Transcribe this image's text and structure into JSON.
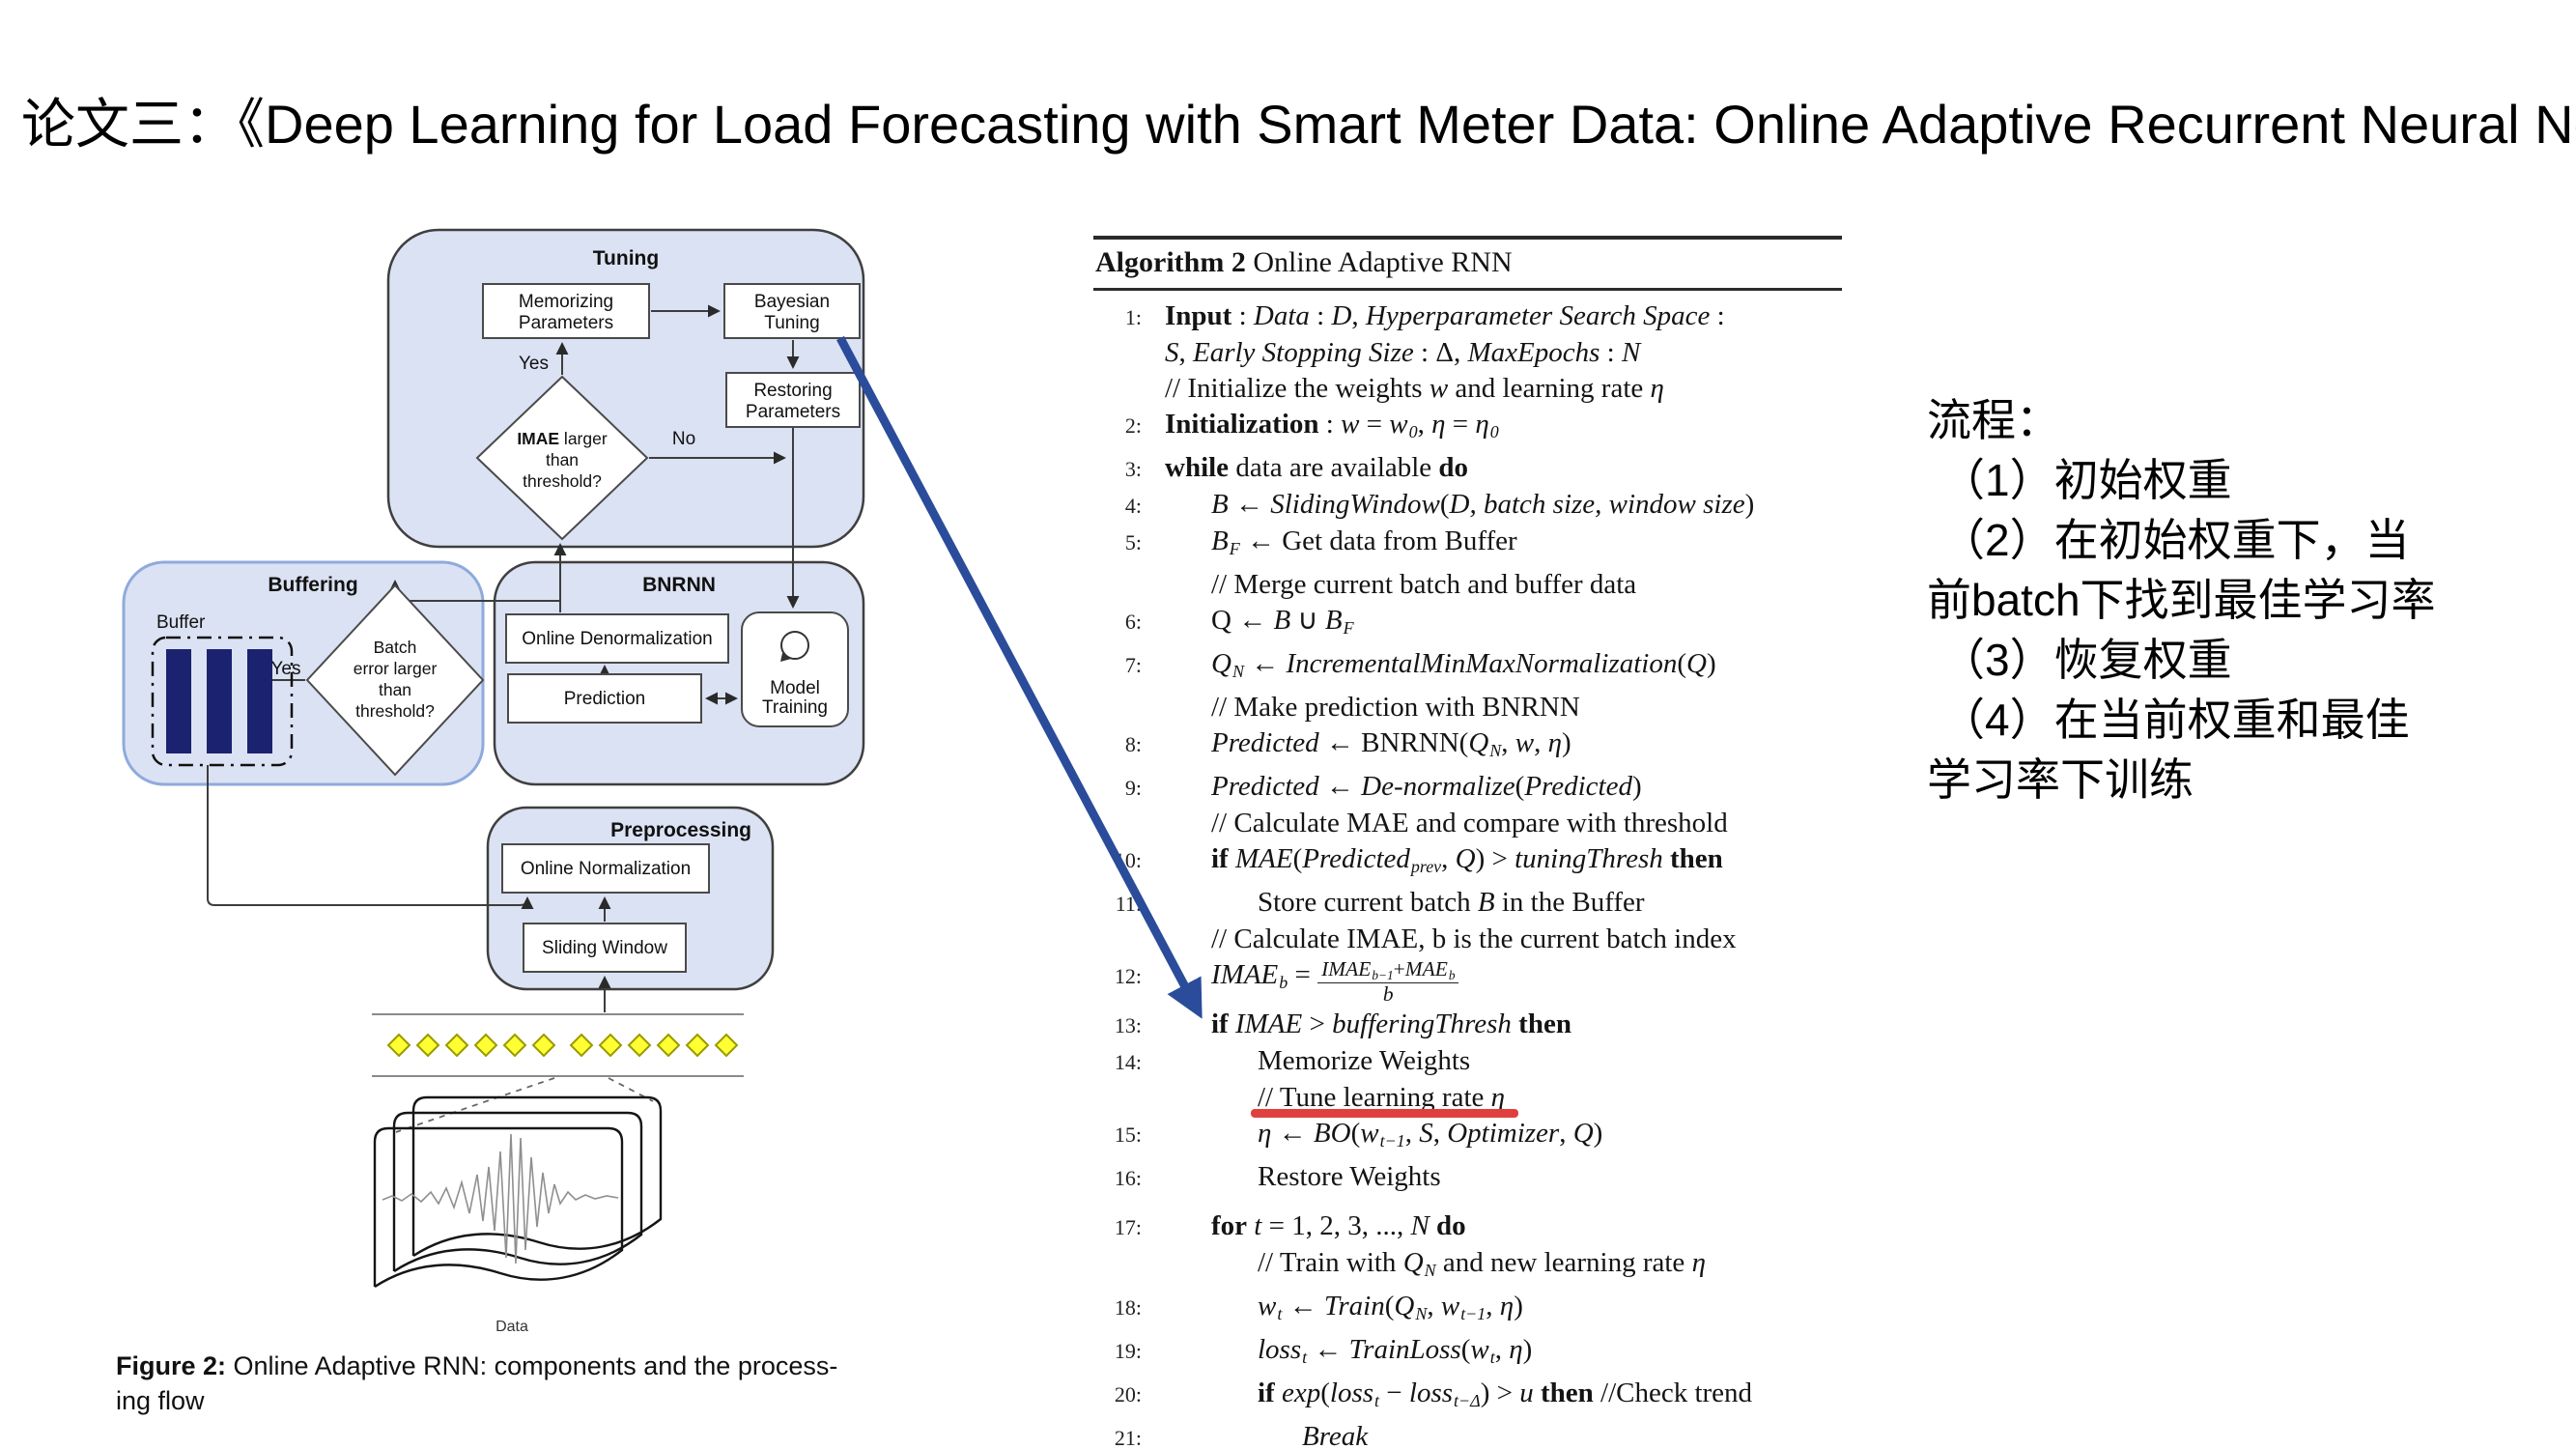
{
  "title": "论文三：《Deep Learning for Load Forecasting with Smart Meter Data: Online Adaptive Recurrent Neural Network》",
  "colors": {
    "accent_blue": "#2b4c9b",
    "underline_red": "#e0403d",
    "container_fill": "#dbe2f3",
    "container_border": "#3f3f3f",
    "buffering_border": "#8faadc",
    "bar_navy": "#1b2370",
    "stream_yellow": "#ffff33",
    "stream_border": "#9a9a00"
  },
  "flowchart": {
    "sections": {
      "tuning": "Tuning",
      "buffering": "Buffering",
      "bnrnn": "BNRNN",
      "preprocessing": "Preprocessing"
    },
    "boxes": {
      "memorizing": [
        "Memorizing",
        "Parameters"
      ],
      "bayesian": [
        "Bayesian",
        "Tuning"
      ],
      "restoring": [
        "Restoring",
        "Parameters"
      ],
      "online_denorm": "Online Denormalization",
      "prediction": "Prediction",
      "model_training": [
        "Model",
        "Training"
      ],
      "online_norm": "Online Normalization",
      "sliding_window": "Sliding Window"
    },
    "diamonds": {
      "imae": {
        "l1b": "IMAE",
        "l1r": " larger",
        "l2": "than",
        "l3": "threshold?"
      },
      "batch": [
        "Batch",
        "error larger",
        "than",
        "threshold?"
      ]
    },
    "labels": {
      "buffer": "Buffer",
      "yes_tuning": "Yes",
      "no_tuning": "No",
      "yes_buffering": "Yes",
      "data": "Data"
    },
    "caption": {
      "prefix": "Figure 2:",
      "line1": " Online Adaptive RNN: components and the process-",
      "line2": "ing flow"
    }
  },
  "algorithm": {
    "header": {
      "bold": "Algorithm 2",
      "rest": " Online Adaptive RNN"
    },
    "lines": [
      {
        "n": "1:",
        "ind": 0,
        "seg": [
          [
            "b",
            "Input"
          ],
          [
            "r",
            " : "
          ],
          [
            "i",
            "Data"
          ],
          [
            "r",
            " : "
          ],
          [
            "i",
            "D"
          ],
          [
            "r",
            ", "
          ],
          [
            "i",
            "Hyperparameter Search Space"
          ],
          [
            "r",
            " :"
          ]
        ]
      },
      {
        "n": "",
        "ind": 0,
        "seg": [
          [
            "i",
            "S"
          ],
          [
            "r",
            ", "
          ],
          [
            "i",
            "Early Stopping Size"
          ],
          [
            "r",
            " : Δ, "
          ],
          [
            "i",
            "MaxEpochs"
          ],
          [
            "r",
            " : "
          ],
          [
            "i",
            "N"
          ]
        ]
      },
      {
        "n": "",
        "ind": 0,
        "seg": [
          [
            "r",
            "// Initialize the weights "
          ],
          [
            "i",
            "w"
          ],
          [
            "r",
            " and learning rate "
          ],
          [
            "i",
            "η"
          ]
        ]
      },
      {
        "n": "2:",
        "ind": 0,
        "seg": [
          [
            "b",
            "Initialization"
          ],
          [
            "r",
            " : "
          ],
          [
            "i",
            "w"
          ],
          [
            "r",
            " = "
          ],
          [
            "i",
            "w"
          ],
          [
            "s",
            "0"
          ],
          [
            "r",
            ", "
          ],
          [
            "i",
            "η"
          ],
          [
            "r",
            " = "
          ],
          [
            "i",
            "η"
          ],
          [
            "s",
            "0"
          ]
        ]
      },
      {
        "n": "3:",
        "ind": 0,
        "seg": [
          [
            "b",
            "while"
          ],
          [
            "r",
            " data are available "
          ],
          [
            "b",
            "do"
          ]
        ]
      },
      {
        "n": "4:",
        "ind": 1,
        "seg": [
          [
            "i",
            "B"
          ],
          [
            "r",
            " ← "
          ],
          [
            "i",
            "SlidingWindow"
          ],
          [
            "r",
            "("
          ],
          [
            "i",
            "D, batch size, window size"
          ],
          [
            "r",
            ")"
          ]
        ]
      },
      {
        "n": "5:",
        "ind": 1,
        "seg": [
          [
            "i",
            "B"
          ],
          [
            "s",
            "F"
          ],
          [
            "r",
            " ← Get data from Buffer"
          ]
        ]
      },
      {
        "n": "",
        "ind": 1,
        "seg": [
          [
            "r",
            "// Merge current batch and buffer data"
          ]
        ]
      },
      {
        "n": "6:",
        "ind": 1,
        "seg": [
          [
            "r",
            "Q ← "
          ],
          [
            "i",
            "B"
          ],
          [
            "r",
            " ∪ "
          ],
          [
            "i",
            "B"
          ],
          [
            "s",
            "F"
          ]
        ]
      },
      {
        "n": "7:",
        "ind": 1,
        "seg": [
          [
            "i",
            "Q"
          ],
          [
            "s",
            "N"
          ],
          [
            "r",
            " ← "
          ],
          [
            "i",
            "IncrementalMinMaxNormalization"
          ],
          [
            "r",
            "("
          ],
          [
            "i",
            "Q"
          ],
          [
            "r",
            ")"
          ]
        ]
      },
      {
        "n": "",
        "ind": 1,
        "seg": [
          [
            "r",
            "// Make prediction with BNRNN"
          ]
        ]
      },
      {
        "n": "8:",
        "ind": 1,
        "seg": [
          [
            "i",
            "Predicted"
          ],
          [
            "r",
            " ← BNRNN("
          ],
          [
            "i",
            "Q"
          ],
          [
            "s",
            "N"
          ],
          [
            "r",
            ", "
          ],
          [
            "i",
            "w"
          ],
          [
            "r",
            ", "
          ],
          [
            "i",
            "η"
          ],
          [
            "r",
            ")"
          ]
        ]
      },
      {
        "n": "9:",
        "ind": 1,
        "seg": [
          [
            "i",
            "Predicted"
          ],
          [
            "r",
            " ← "
          ],
          [
            "i",
            "De-normalize"
          ],
          [
            "r",
            "("
          ],
          [
            "i",
            "Predicted"
          ],
          [
            "r",
            ")"
          ]
        ]
      },
      {
        "n": "",
        "ind": 1,
        "seg": [
          [
            "r",
            "// Calculate MAE and compare with threshold"
          ]
        ]
      },
      {
        "n": "10:",
        "ind": 1,
        "seg": [
          [
            "b",
            "if"
          ],
          [
            "r",
            " "
          ],
          [
            "i",
            "MAE"
          ],
          [
            "r",
            "("
          ],
          [
            "i",
            "Predicted"
          ],
          [
            "s",
            "prev"
          ],
          [
            "r",
            ", "
          ],
          [
            "i",
            "Q"
          ],
          [
            "r",
            ") > "
          ],
          [
            "i",
            "tuningThresh"
          ],
          [
            "r",
            " "
          ],
          [
            "b",
            "then"
          ]
        ]
      },
      {
        "n": "11:",
        "ind": 2,
        "seg": [
          [
            "r",
            "Store current batch "
          ],
          [
            "i",
            "B"
          ],
          [
            "r",
            " in the Buffer"
          ]
        ]
      },
      {
        "n": "",
        "ind": 1,
        "seg": [
          [
            "r",
            "// Calculate IMAE, b is the current batch index"
          ]
        ]
      },
      {
        "n": "12:",
        "ind": 1,
        "seg": [
          [
            "i",
            "IMAE"
          ],
          [
            "s",
            "b"
          ],
          [
            "r",
            " = "
          ],
          [
            "f",
            {
              "n": [
                [
                  "i",
                  "IMAE"
                ],
                [
                  "s",
                  "b−1"
                ],
                [
                  "r",
                  "+"
                ],
                [
                  "i",
                  "MAE"
                ],
                [
                  "s",
                  "b"
                ]
              ],
              "d": [
                [
                  "i",
                  "b"
                ]
              ]
            }
          ]
        ]
      },
      {
        "n": "13:",
        "ind": 1,
        "seg": [
          [
            "b",
            "if"
          ],
          [
            "r",
            " "
          ],
          [
            "i",
            "IMAE"
          ],
          [
            "r",
            " > "
          ],
          [
            "i",
            "bufferingThresh"
          ],
          [
            "r",
            " "
          ],
          [
            "b",
            "then"
          ]
        ]
      },
      {
        "n": "14:",
        "ind": 2,
        "seg": [
          [
            "r",
            "Memorize Weights"
          ]
        ]
      },
      {
        "n": "",
        "ind": 2,
        "ul": true,
        "seg": [
          [
            "r",
            "// Tune learning rate "
          ],
          [
            "i",
            "η"
          ]
        ]
      },
      {
        "n": "15:",
        "ind": 2,
        "seg": [
          [
            "i",
            "η"
          ],
          [
            "r",
            " ← "
          ],
          [
            "i",
            "BO"
          ],
          [
            "r",
            "("
          ],
          [
            "i",
            "w"
          ],
          [
            "s",
            "t−1"
          ],
          [
            "r",
            ", "
          ],
          [
            "i",
            "S"
          ],
          [
            "r",
            ", "
          ],
          [
            "i",
            "Optimizer"
          ],
          [
            "r",
            ", "
          ],
          [
            "i",
            "Q"
          ],
          [
            "r",
            ")"
          ]
        ]
      },
      {
        "n": "16:",
        "ind": 2,
        "seg": [
          [
            "r",
            "Restore Weights"
          ]
        ]
      },
      {
        "n": "17:",
        "ind": 1,
        "gap": true,
        "seg": [
          [
            "b",
            "for"
          ],
          [
            "r",
            " "
          ],
          [
            "i",
            "t"
          ],
          [
            "r",
            " = 1, 2, 3, ..., "
          ],
          [
            "i",
            "N"
          ],
          [
            "r",
            " "
          ],
          [
            "b",
            "do"
          ]
        ]
      },
      {
        "n": "",
        "ind": 2,
        "seg": [
          [
            "r",
            "// Train with "
          ],
          [
            "i",
            "Q"
          ],
          [
            "s",
            "N"
          ],
          [
            "r",
            " and new learning rate "
          ],
          [
            "i",
            "η"
          ]
        ]
      },
      {
        "n": "18:",
        "ind": 2,
        "seg": [
          [
            "i",
            "w"
          ],
          [
            "s",
            "t"
          ],
          [
            "r",
            " ← "
          ],
          [
            "i",
            "Train"
          ],
          [
            "r",
            "("
          ],
          [
            "i",
            "Q"
          ],
          [
            "s",
            "N"
          ],
          [
            "r",
            ", "
          ],
          [
            "i",
            "w"
          ],
          [
            "s",
            "t−1"
          ],
          [
            "r",
            ", "
          ],
          [
            "i",
            "η"
          ],
          [
            "r",
            ")"
          ]
        ]
      },
      {
        "n": "19:",
        "ind": 2,
        "seg": [
          [
            "i",
            "loss"
          ],
          [
            "s",
            "t"
          ],
          [
            "r",
            " ← "
          ],
          [
            "i",
            "TrainLoss"
          ],
          [
            "r",
            "("
          ],
          [
            "i",
            "w"
          ],
          [
            "s",
            "t"
          ],
          [
            "r",
            ", "
          ],
          [
            "i",
            "η"
          ],
          [
            "r",
            ")"
          ]
        ]
      },
      {
        "n": "20:",
        "ind": 2,
        "seg": [
          [
            "b",
            "if"
          ],
          [
            "r",
            " "
          ],
          [
            "i",
            "exp"
          ],
          [
            "r",
            "("
          ],
          [
            "i",
            "loss"
          ],
          [
            "s",
            "t"
          ],
          [
            "r",
            " − "
          ],
          [
            "i",
            "loss"
          ],
          [
            "s",
            "t−Δ"
          ],
          [
            "r",
            ") > "
          ],
          [
            "i",
            "u"
          ],
          [
            "r",
            " "
          ],
          [
            "b",
            "then"
          ],
          [
            "r",
            " //Check trend"
          ]
        ]
      },
      {
        "n": "21:",
        "ind": 3,
        "seg": [
          [
            "i",
            "Break"
          ]
        ]
      }
    ]
  },
  "notes": {
    "lines": [
      "流程：",
      "（1）初始权重",
      "（2）在初始权重下，当",
      "前batch下找到最佳学习率",
      "（3）恢复权重",
      "（4）在当前权重和最佳",
      "学习率下训练"
    ]
  }
}
